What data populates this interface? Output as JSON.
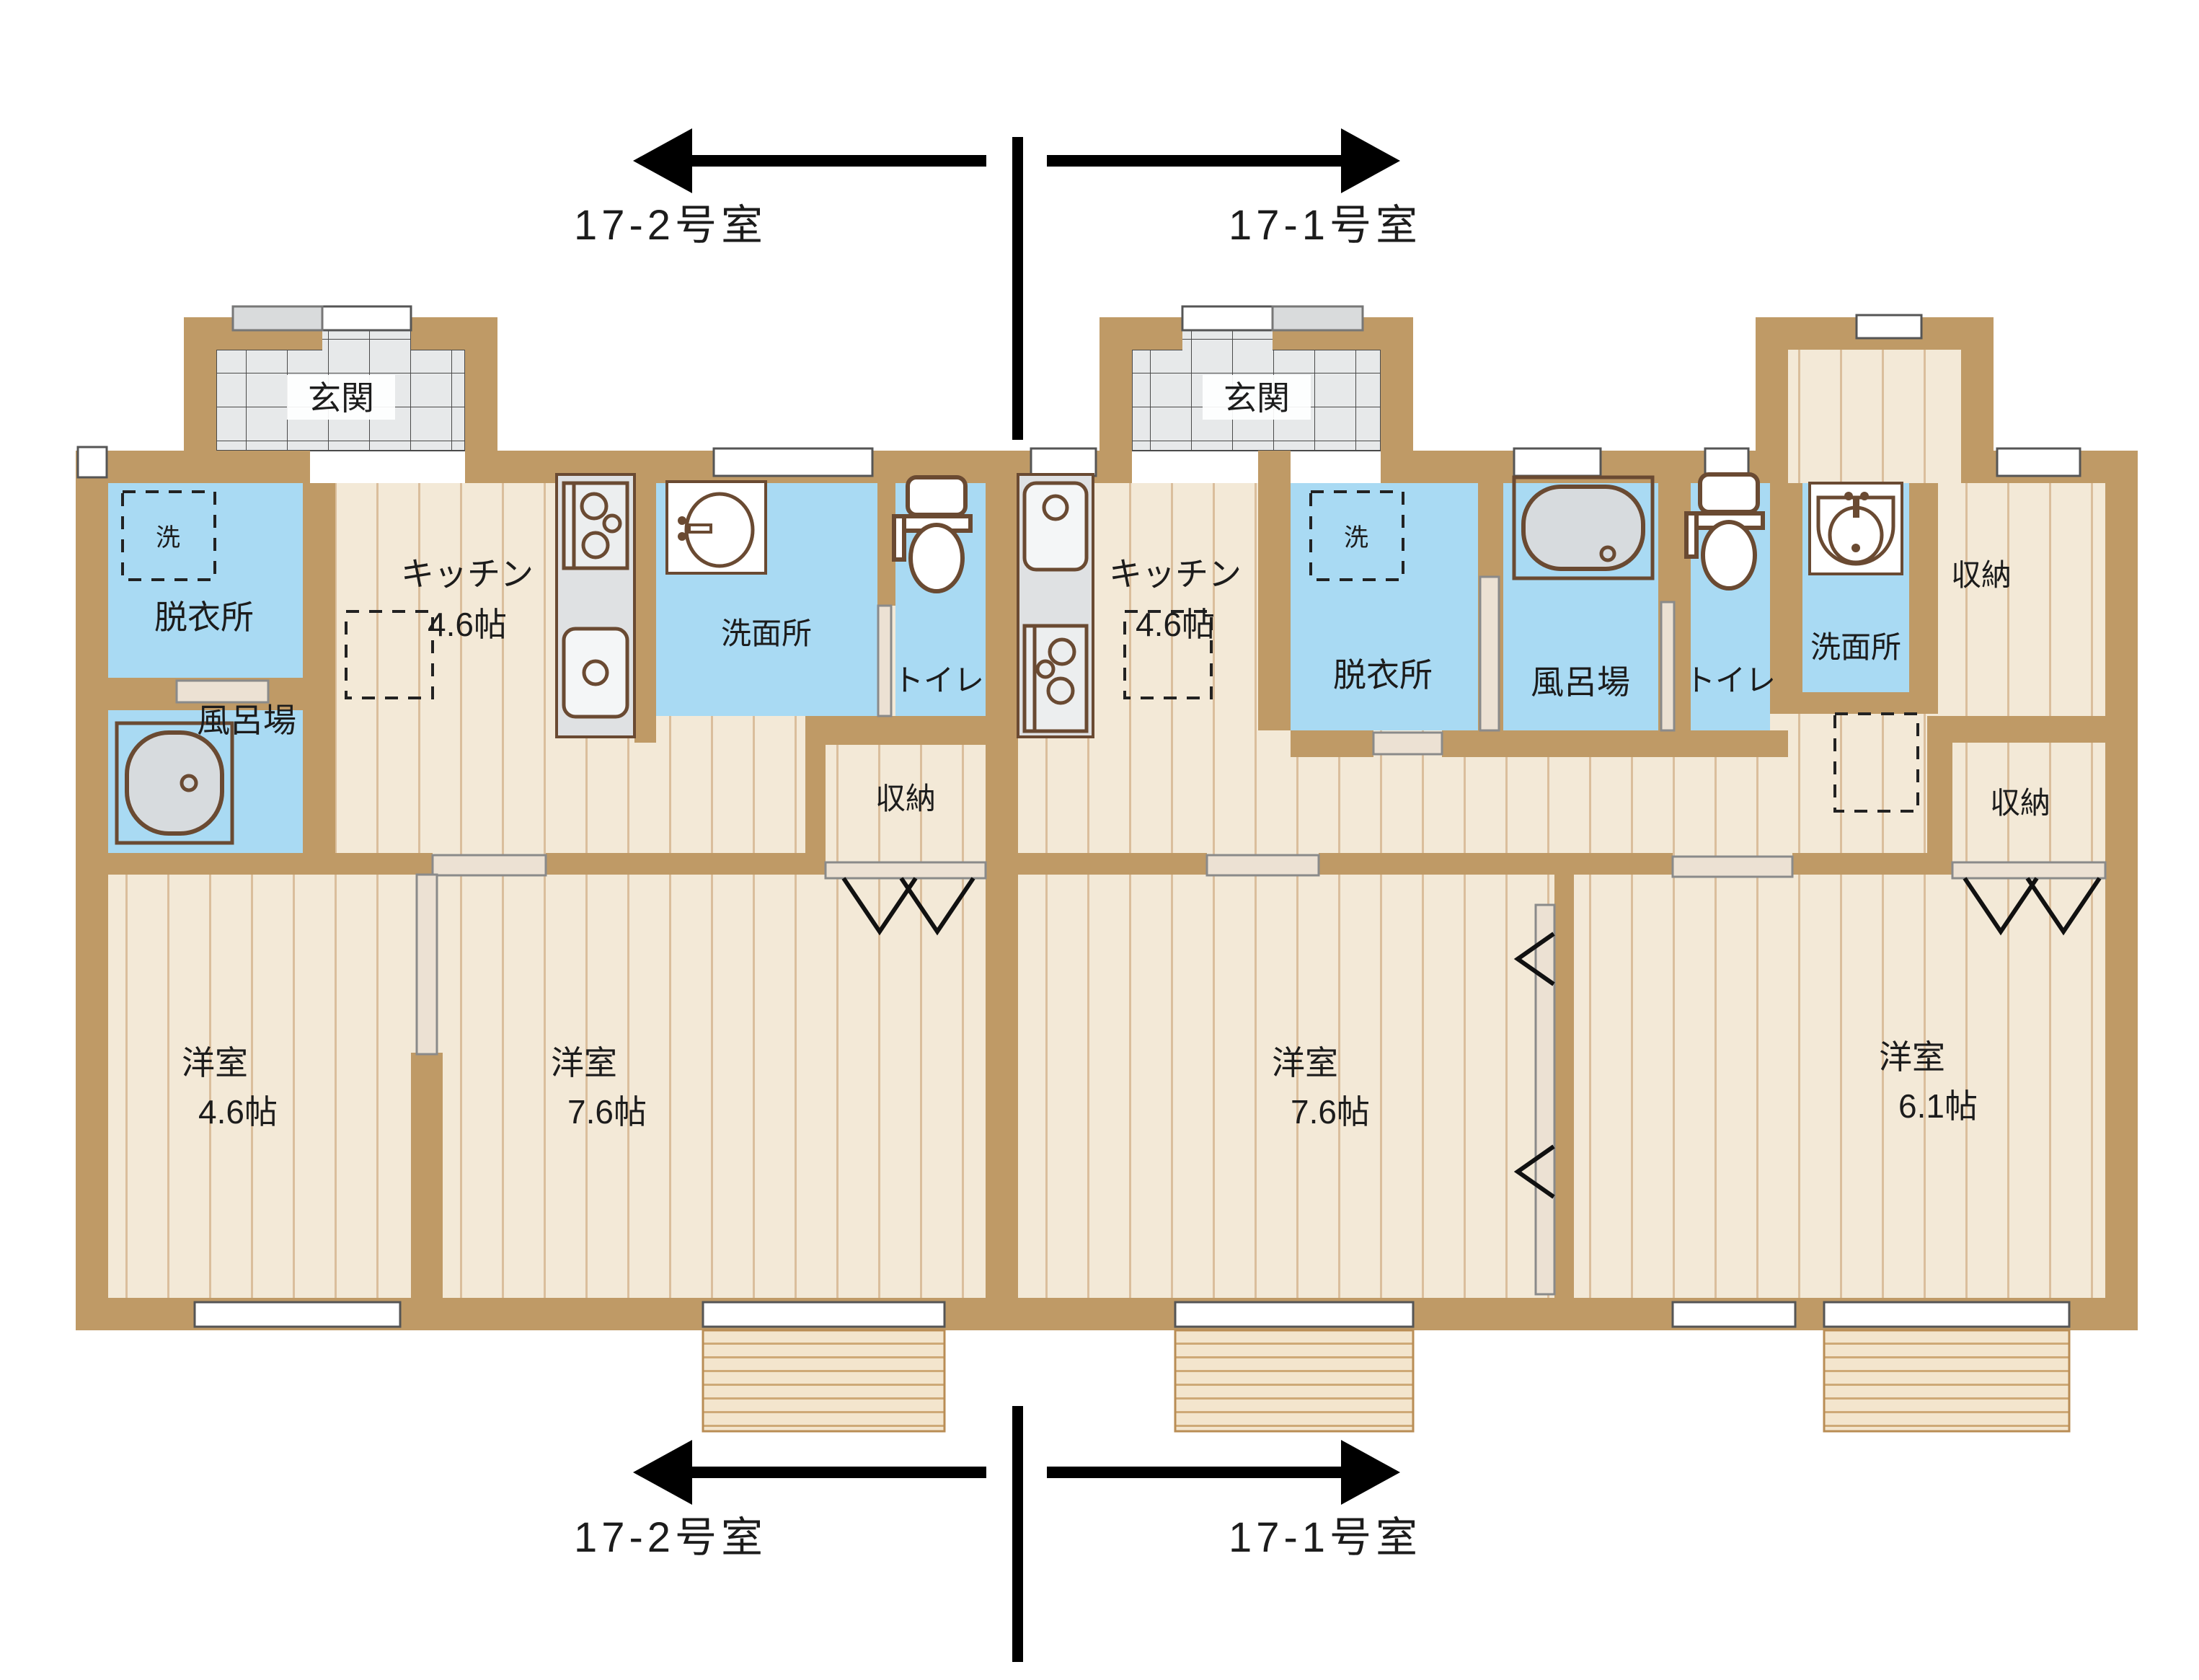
{
  "plan": {
    "type": "floorplan",
    "units": {
      "left_label": "17-2号室",
      "right_label": "17-1号室"
    },
    "unit_left": {
      "genkan": "玄関",
      "datsuijo": "脱衣所",
      "laundry": "洗",
      "kitchen": "キッチン",
      "kitchen_size": "4.6帖",
      "senmenjo": "洗面所",
      "toilet": "トイレ",
      "furoba": "風呂場",
      "shuno": "収納",
      "bedroom1": "洋室",
      "bedroom1_size": "4.6帖",
      "bedroom2": "洋室",
      "bedroom2_size": "7.6帖"
    },
    "unit_right": {
      "genkan": "玄関",
      "datsuijo": "脱衣所",
      "laundry": "洗",
      "kitchen": "キッチン",
      "kitchen_size": "4.6帖",
      "furoba": "風呂場",
      "toilet": "トイレ",
      "senmenjo": "洗面所",
      "shuno_hall": "収納",
      "shuno_closet": "収納",
      "bedroom1": "洋室",
      "bedroom1_size": "7.6帖",
      "bedroom2": "洋室",
      "bedroom2_size": "6.1帖"
    },
    "colors": {
      "wall": "#bf9a66",
      "water_room": "#a9daf3",
      "floor": "#f3e9d7",
      "plank_line": "#c49a6b",
      "entry_tile": "#e7e9ea",
      "counter": "#dfe1e3",
      "fixture_outline": "#6a4a32",
      "balcony": "#f3e5cd",
      "annotation": "#111111"
    }
  }
}
